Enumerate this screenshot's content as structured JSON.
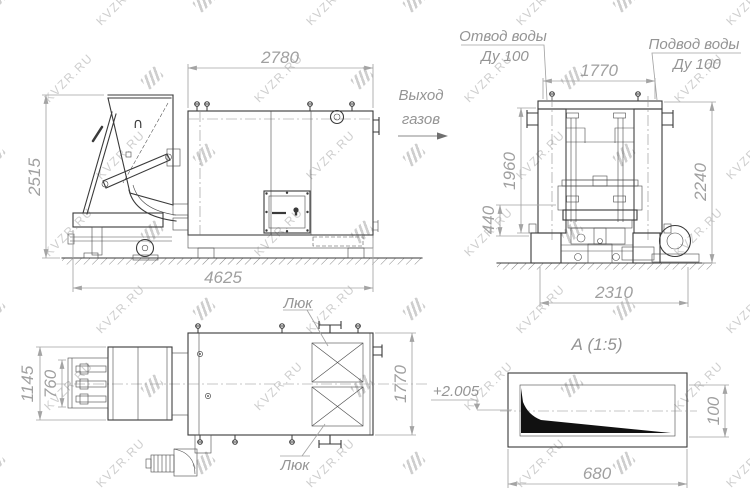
{
  "watermark": {
    "text": "KVZR.RU",
    "color": "#c6c6c6"
  },
  "colors": {
    "background": "#ffffff",
    "object_line": "#3a3a3a",
    "dimension_line": "#a4a4a4",
    "dimension_text": "#a0a0a0",
    "annotation_text": "#949494",
    "detail_fill": "#111111"
  },
  "views": {
    "side": {
      "hopper_mark": "∩",
      "dim_width": "2780",
      "dim_height": "2515",
      "dim_length": "4625"
    },
    "front": {
      "label_water_outlet_1": "Отвод воды",
      "label_water_outlet_2": "Ду 100",
      "label_water_inlet_1": "Подвод воды",
      "label_water_inlet_2": "Ду 100",
      "label_gas_1": "Выход",
      "label_gas_2": "газов",
      "dim_width_top": "1770",
      "dim_height_inner": "1960",
      "dim_base": "440",
      "dim_height_outer": "2240",
      "dim_width_bottom": "2310"
    },
    "plan": {
      "label_hatch_top": "Люк",
      "label_hatch_bottom": "Люк",
      "dim_outer": "1145",
      "dim_inner": "760",
      "dim_height": "1770"
    },
    "detail": {
      "title": "А (1:5)",
      "elevation_mark": "+2.005",
      "dim_width": "680",
      "dim_height": "100"
    }
  }
}
